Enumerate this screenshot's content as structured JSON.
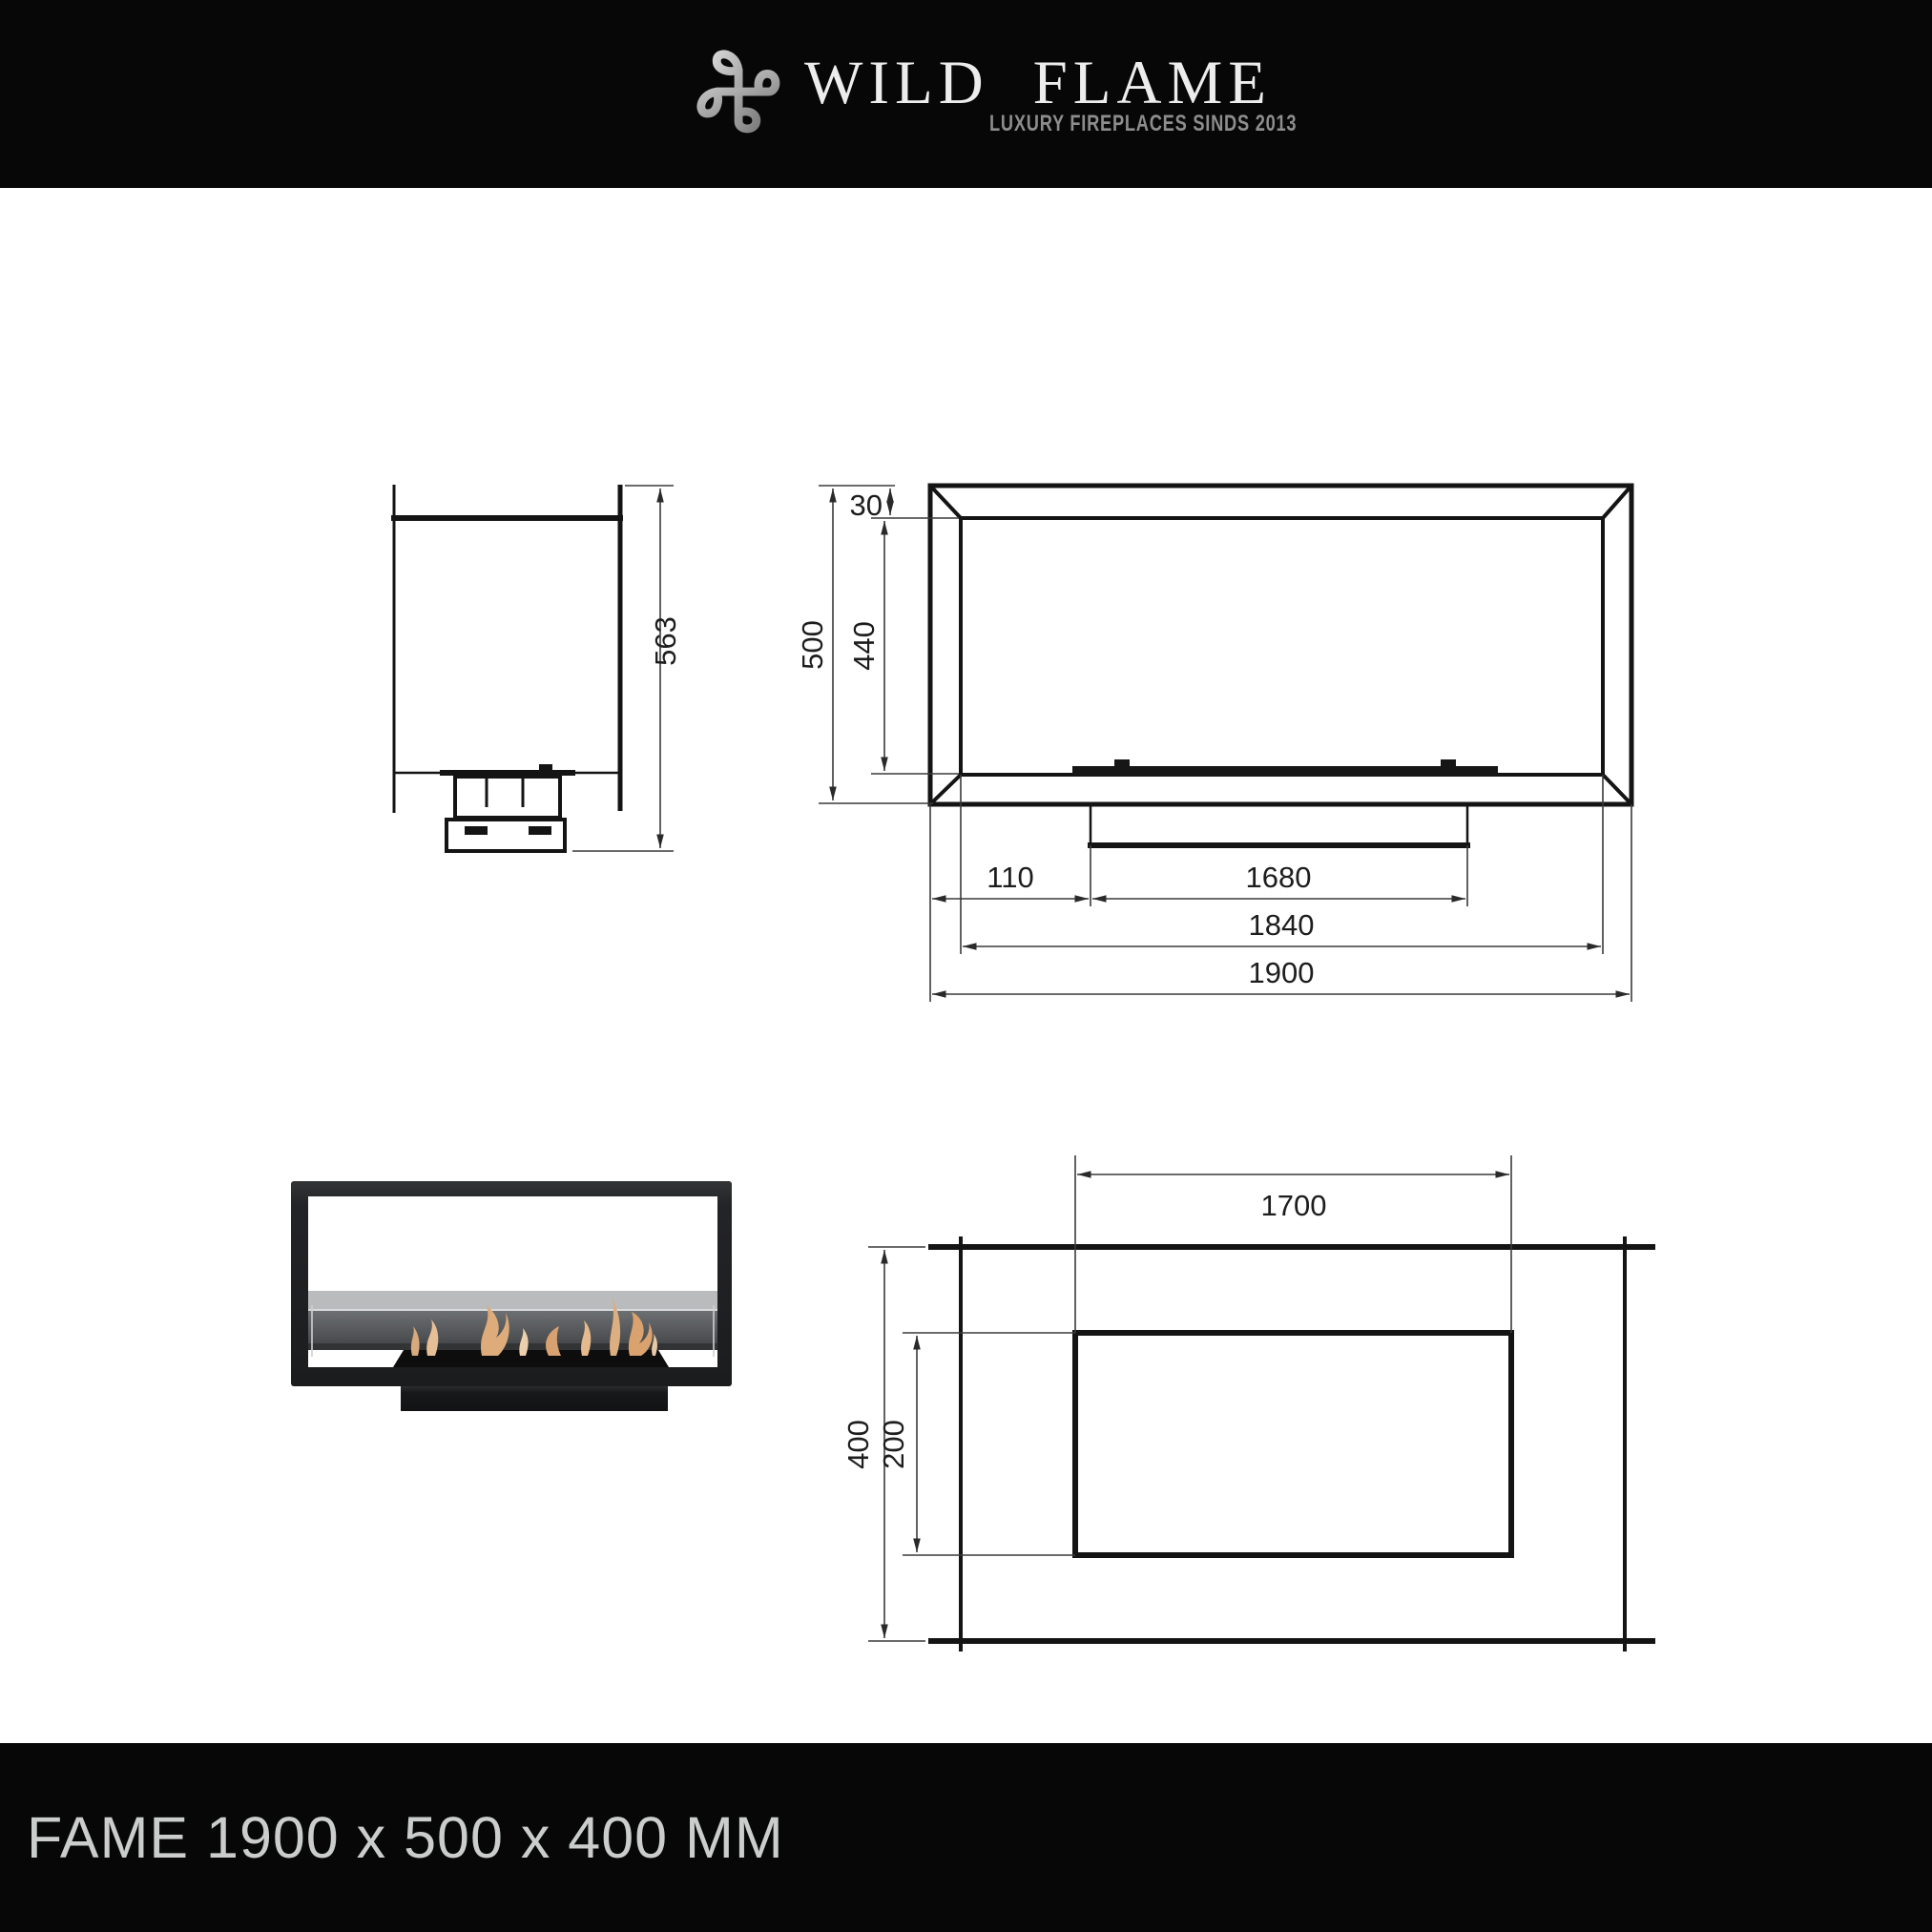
{
  "header": {
    "brand": {
      "word1": "WILD",
      "word2": "FLAME"
    },
    "tagline": "LUXURY FIREPLACES SINDS 2013",
    "colors": {
      "band": "#070707",
      "brand_text": "#ededed",
      "tagline_text": "#8d8d8d",
      "logo_silver": "#9a9a9a"
    }
  },
  "footer": {
    "title": "FAME 1900 x 500 x 400 MM",
    "colors": {
      "band": "#070707",
      "text": "#cbcdcd"
    }
  },
  "side_view": {
    "overall_height_label": "563"
  },
  "front_view": {
    "top_inset_label": "30",
    "inner_height_label": "440",
    "total_height_label": "500",
    "left_offset_label": "110",
    "base_width_label": "1680",
    "inner_width_label": "1840",
    "total_width_label": "1900"
  },
  "top_view": {
    "opening_length_label": "1700",
    "opening_depth_label": "200",
    "total_depth_label": "400"
  },
  "photo": {
    "colors": {
      "frame": "#212225",
      "glass_upper": "#b9bbbd",
      "glass_lower": "#5d6063",
      "flame": "#dcae80",
      "burner": "#0d0d0e"
    }
  }
}
